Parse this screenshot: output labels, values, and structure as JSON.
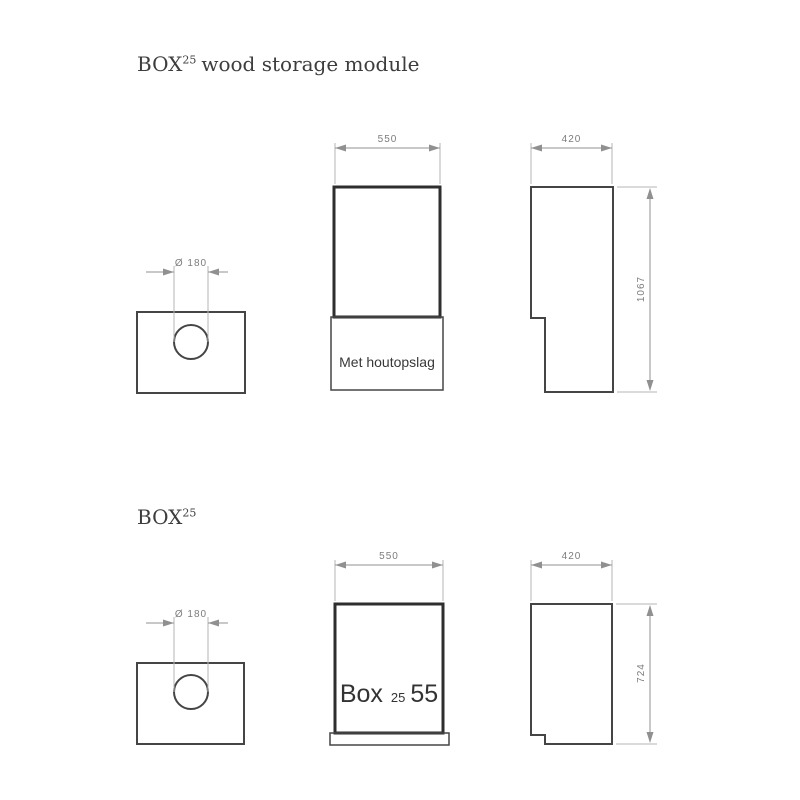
{
  "colors": {
    "background": "#ffffff",
    "outline_heavy": "#2e2e2e",
    "outline": "#454545",
    "dimension": "#909090",
    "text_title": "#3d3d3d",
    "text_dim": "#7c7c7c"
  },
  "drawings": [
    {
      "title": {
        "main": "BOX",
        "sup": "25",
        "rest": "wood storage module"
      },
      "top_view": {
        "diameter": "Ø 180"
      },
      "front_view": {
        "width": "550",
        "label": "Met houtopslag"
      },
      "side_view": {
        "width": "420",
        "height": "1067"
      }
    },
    {
      "title": {
        "main": "BOX",
        "sup": "25",
        "rest": ""
      },
      "top_view": {
        "diameter": "Ø 180"
      },
      "front_view": {
        "width": "550",
        "label": {
          "main": "Box",
          "sup": "25",
          "rest": "55"
        }
      },
      "side_view": {
        "width": "420",
        "height": "724"
      }
    }
  ]
}
